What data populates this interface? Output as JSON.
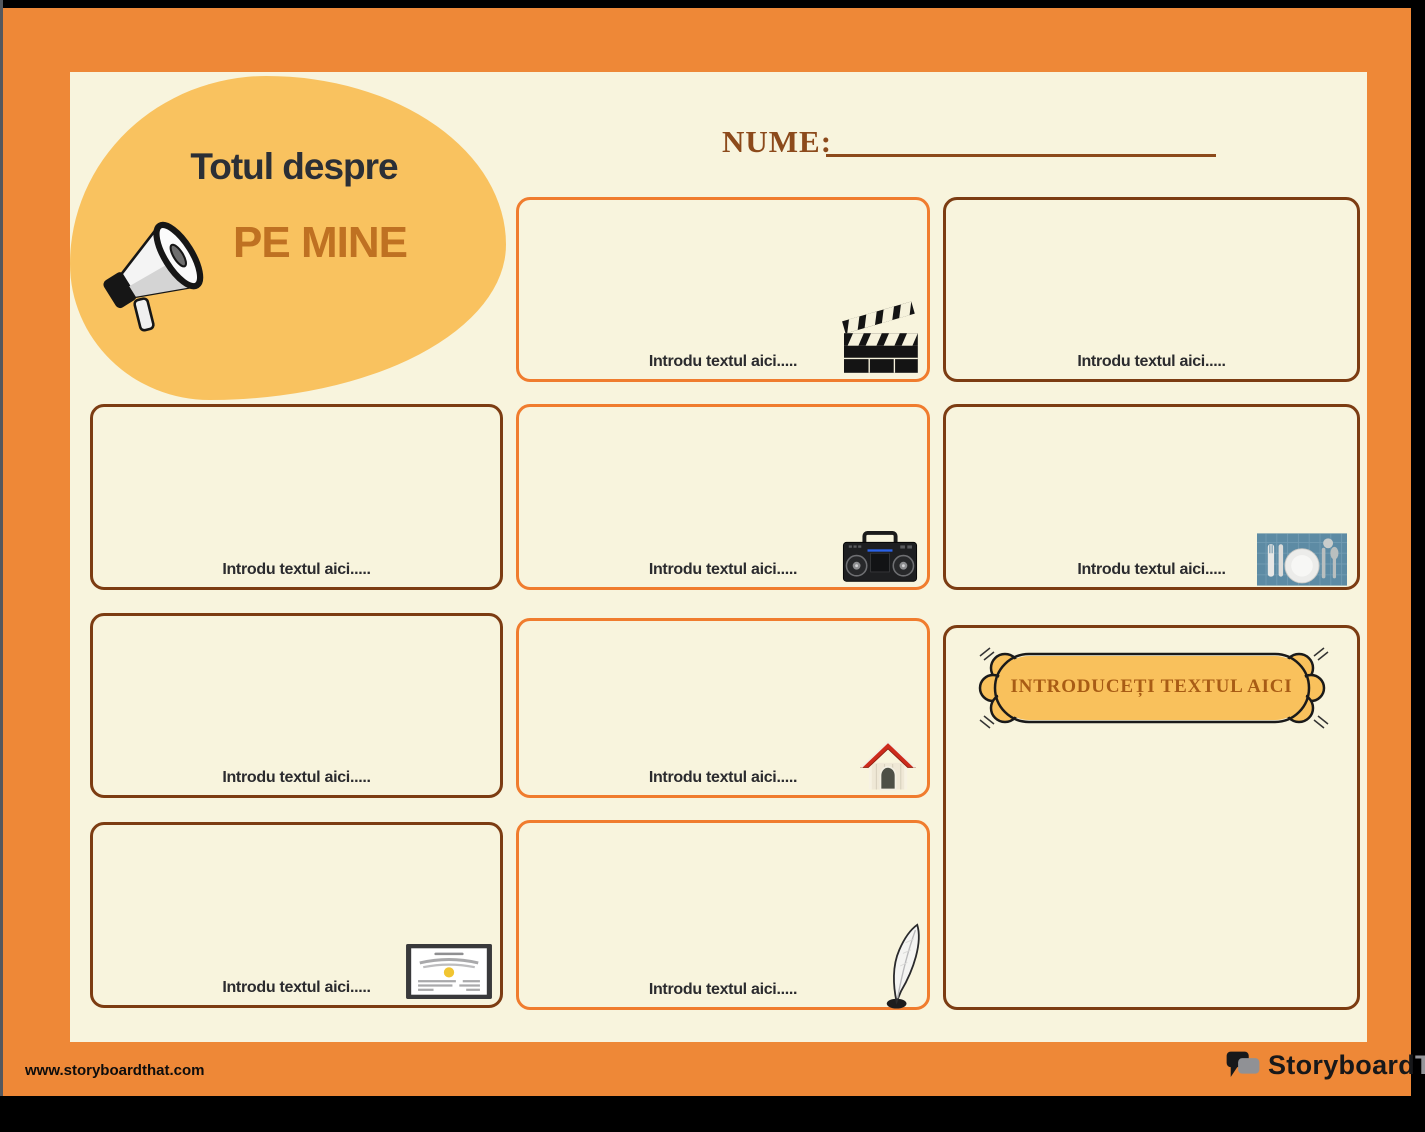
{
  "header": {
    "title_line1": "Totul despre",
    "title_line2": "PE MINE",
    "name_label": "NUME:",
    "megaphone_icon": "megaphone-icon"
  },
  "placeholder_text": "Introdu textul aici.....",
  "boxes": [
    {
      "id": "box-top-middle",
      "label": "Introdu textul aici.....",
      "icon": "clapperboard-icon",
      "border_color": "#f07c2e"
    },
    {
      "id": "box-top-right",
      "label": "Introdu textul aici.....",
      "icon": null,
      "border_color": "#7c3c12"
    },
    {
      "id": "box-r2-left",
      "label": "Introdu textul aici.....",
      "icon": null,
      "border_color": "#7c3c12"
    },
    {
      "id": "box-r2-middle",
      "label": "Introdu textul aici.....",
      "icon": "boombox-radio-icon",
      "border_color": "#f07c2e"
    },
    {
      "id": "box-r2-right",
      "label": "Introdu textul aici.....",
      "icon": "placemat-dinner-setting-icon",
      "border_color": "#7c3c12"
    },
    {
      "id": "box-r3-left",
      "label": "Introdu textul aici.....",
      "icon": null,
      "border_color": "#7c3c12"
    },
    {
      "id": "box-r3-middle",
      "label": "Introdu textul aici.....",
      "icon": "dog-house-icon",
      "border_color": "#f07c2e"
    },
    {
      "id": "box-r4-left",
      "label": "Introdu textul aici.....",
      "icon": "certificate-icon",
      "border_color": "#7c3c12"
    },
    {
      "id": "box-r4-middle",
      "label": "Introdu textul aici.....",
      "icon": "feather-quill-icon",
      "border_color": "#f07c2e"
    }
  ],
  "banner": {
    "label": "INTRODUCEȚI TEXTUL AICI",
    "fill": "#f9c15c",
    "text_color": "#a85c15"
  },
  "footer": {
    "website": "www.storyboardthat.com",
    "logo_part1": "Storyboard",
    "logo_part2": "That",
    "logo_icon": "speech-bubbles-icon"
  },
  "colors": {
    "frame_orange": "#ee8837",
    "panel_cream": "#f8f4dd",
    "blob_yellow": "#f9c25f",
    "orange_box_border": "#f07c2e",
    "brown_box_border": "#7c3c12",
    "title_dark": "#2b2f36",
    "title_orange": "#bf7122",
    "name_brown": "#8c4a1b",
    "label_dark": "#2b2b2e",
    "logo_gray": "#94959a"
  }
}
